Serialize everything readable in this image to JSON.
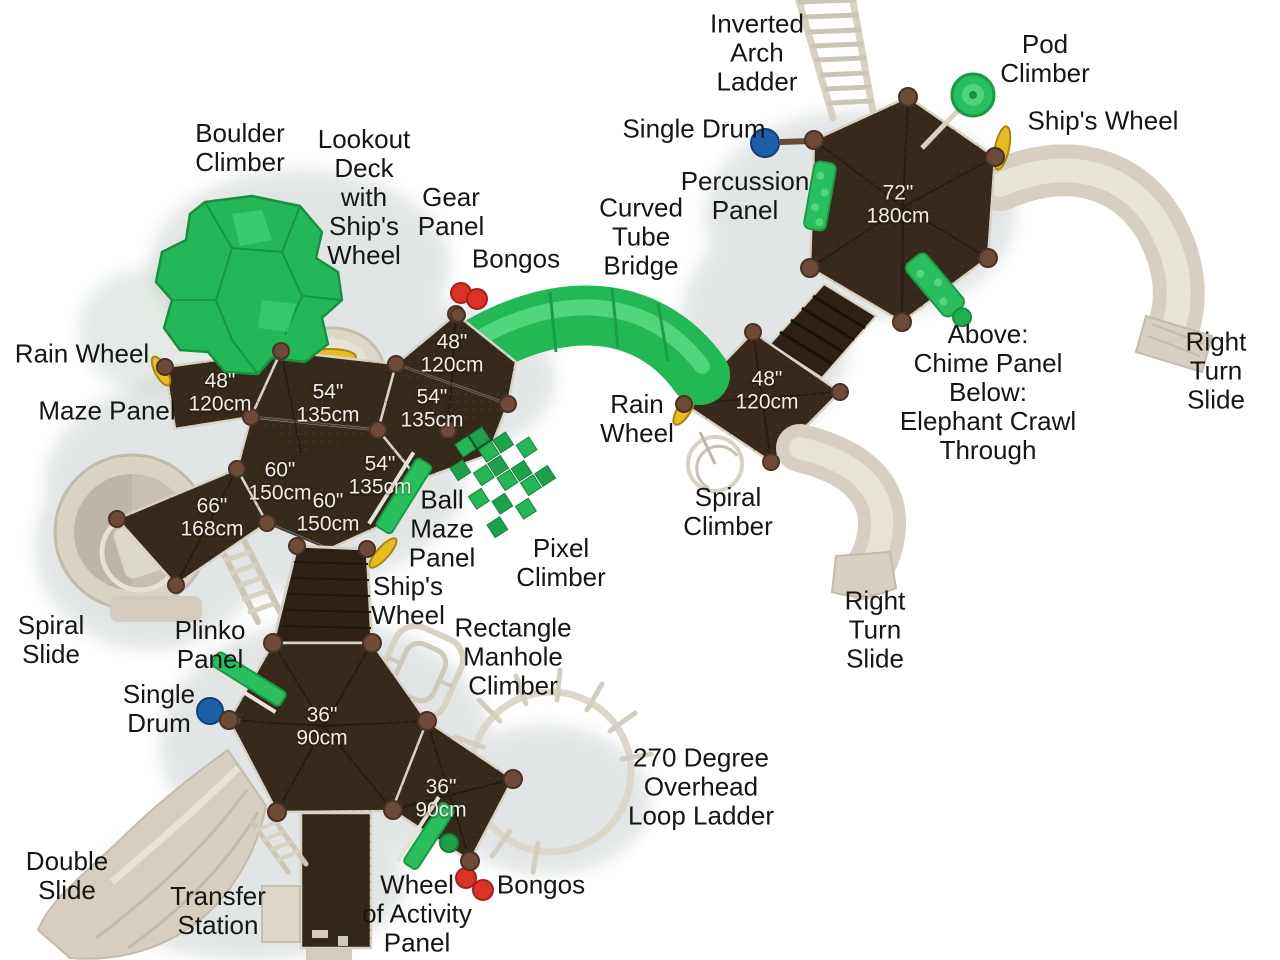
{
  "colors": {
    "deck_brown": "#36291b",
    "walkway_brown": "#2c2114",
    "accent_green": "#23b757",
    "tube_green": "#24b855",
    "slide_beige": "#d6cfc2",
    "post_brown": "#6e4b39",
    "wheel_yellow": "#e7bc24",
    "drum_blue": "#1d5fa6",
    "bongo_red": "#d93025"
  },
  "labels": {
    "inverted_arch_ladder": "Inverted\nArch\nLadder",
    "pod_climber": "Pod\nClimber",
    "ships_wheel_top": "Ship's Wheel",
    "single_drum_top": "Single Drum",
    "percussion_panel": "Percussion\nPanel",
    "boulder_climber": "Boulder\nClimber",
    "lookout_deck": "Lookout\nDeck\nwith\nShip's\nWheel",
    "gear_panel": "Gear\nPanel",
    "bongos_top": "Bongos",
    "curved_tube_bridge": "Curved\nTube\nBridge",
    "rain_wheel_left": "Rain Wheel",
    "maze_panel": "Maze Panel",
    "rain_wheel_center": "Rain\nWheel",
    "chime_elephant": "Above:\nChime Panel\nBelow:\nElephant Crawl\nThrough",
    "right_turn_slide_top": "Right\nTurn\nSlide",
    "spiral_climber": "Spiral\nClimber",
    "ball_maze_panel": "Ball\nMaze\nPanel",
    "pixel_climber": "Pixel\nClimber",
    "ships_wheel_mid": "Ship's\nWheel",
    "rect_manhole": "Rectangle\nManhole\nClimber",
    "spiral_slide": "Spiral\nSlide",
    "plinko_panel": "Plinko\nPanel",
    "single_drum_bottom": "Single\nDrum",
    "right_turn_slide_bottom": "Right\nTurn\nSlide",
    "loop_ladder": "270 Degree\nOverhead\nLoop Ladder",
    "double_slide": "Double\nSlide",
    "transfer_station": "Transfer\nStation",
    "wheel_of_activity": "Wheel\nof Activity\nPanel",
    "bongos_bottom": "Bongos",
    "deck_72": "72\"\n180cm",
    "deck_48_top": "48\"\n120cm",
    "deck_48_left": "48\"\n120cm",
    "deck_48_right": "48\"\n120cm",
    "deck_54_center": "54\"\n135cm",
    "deck_54_right": "54\"\n135cm",
    "deck_54_small": "54\"\n135cm",
    "deck_60_upper": "60\"\n150cm",
    "deck_60_lower": "60\"\n150cm",
    "deck_66": "66\"\n168cm",
    "deck_36_hex": "36\"\n90cm",
    "deck_36_square": "36\"\n90cm"
  }
}
